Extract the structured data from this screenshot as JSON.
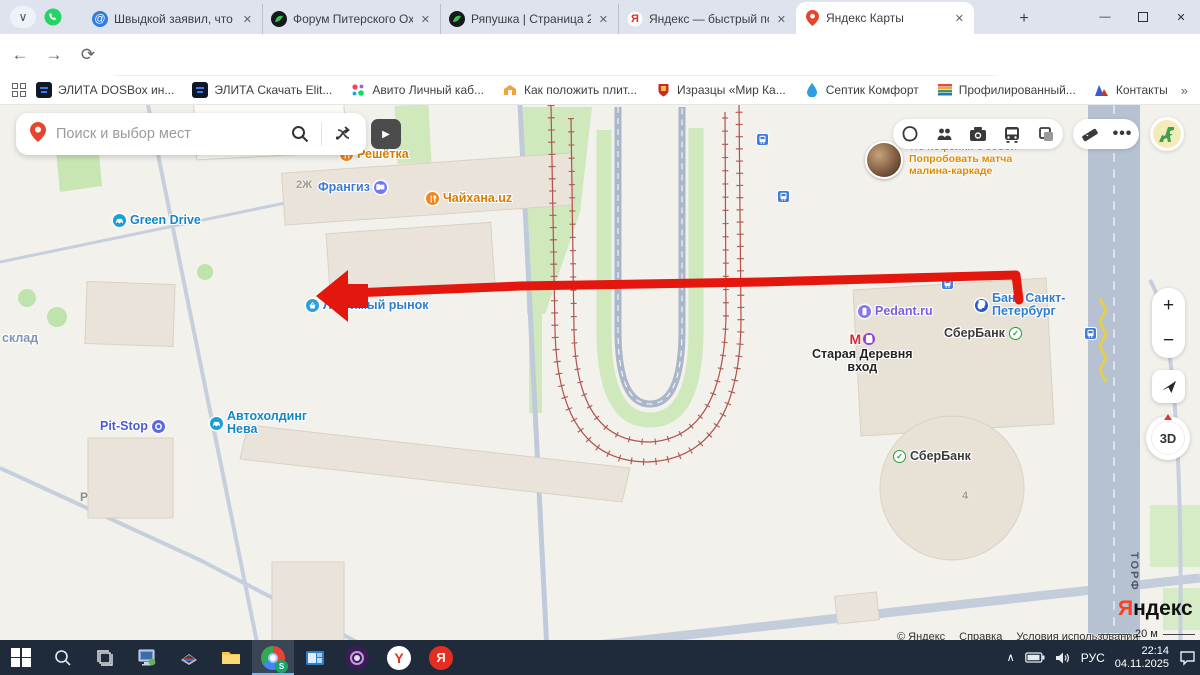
{
  "browser": {
    "tabs": [
      {
        "title": "Швыдкой заявил, что рус",
        "icon": "at-icon",
        "active": false
      },
      {
        "title": "Форум Питерского Охотн",
        "icon": "forum-icon",
        "active": false
      },
      {
        "title": "Ряпушка | Страница 21 | Ф",
        "icon": "forum-icon",
        "active": false
      },
      {
        "title": "Яндекс — быстрый поиск",
        "icon": "yandex-icon",
        "active": false
      },
      {
        "title": "Яндекс Карты",
        "icon": "map-pin-icon",
        "active": true
      }
    ],
    "new_tab_label": "+",
    "url": "yandex.ru/maps/2/saint-petersburg/?ll=30.254433%2C59.989467&utm_campaign=desktop&utm_medium=search&utm_source=maps&z=18.4",
    "profile_initial": "S",
    "bookmarks": [
      {
        "label": "ЭЛИТА DOSBox ин...",
        "icon": "elita-icon"
      },
      {
        "label": "ЭЛИТА Скачать Elit...",
        "icon": "elita-icon"
      },
      {
        "label": "Авито Личный каб...",
        "icon": "avito-icon"
      },
      {
        "label": "Как положить плит...",
        "icon": "tile-icon"
      },
      {
        "label": "Изразцы «Мир Ка...",
        "icon": "shield-icon"
      },
      {
        "label": "Септик Комфорт",
        "icon": "drop-icon"
      },
      {
        "label": "Профилированный...",
        "icon": "stripes-icon"
      },
      {
        "label": "Контакты",
        "icon": "triangle-icon"
      }
    ],
    "bookmarks_more": "»"
  },
  "map": {
    "search_placeholder": "Поиск и выбор мест",
    "promo": {
      "line1": "★5 Кофейня с собой",
      "line2": "Попробовать матча",
      "line3": "малина-каркаде"
    },
    "controls": {
      "zoom_in": "+",
      "zoom_out": "−",
      "compass": "3D"
    },
    "pois": [
      {
        "lines": [
          "Решётка"
        ],
        "x": 340,
        "y": 148,
        "color": "#d87c00",
        "icon": "restaurant-icon",
        "iconBg": "#f0861d",
        "side": "left"
      },
      {
        "lines": [
          "Франгиз"
        ],
        "x": 318,
        "y": 181,
        "color": "#3b7bd8",
        "icon": "scissors-icon",
        "iconBg": "#6f79f7",
        "side": "right"
      },
      {
        "lines": [
          "Чайхана.uz"
        ],
        "x": 426,
        "y": 192,
        "color": "#d87c00",
        "icon": "restaurant-icon",
        "iconBg": "#f0861d",
        "side": "left"
      },
      {
        "lines": [
          "Green Drive"
        ],
        "x": 113,
        "y": 214,
        "color": "#1287c8",
        "icon": "car-icon",
        "iconBg": "#18a0d8",
        "side": "left"
      },
      {
        "lines": [
          "Любимый рынок"
        ],
        "x": 306,
        "y": 299,
        "color": "#2f7dd3",
        "icon": "basket-icon",
        "iconBg": "#28a0dc",
        "side": "left"
      },
      {
        "lines": [
          "склад"
        ],
        "x": 2,
        "y": 332,
        "color": "#7e95b5",
        "icon": null,
        "side": "left"
      },
      {
        "lines": [
          "Pit-Stop"
        ],
        "x": 100,
        "y": 420,
        "color": "#4a5bd0",
        "icon": "tire-icon",
        "iconBg": "#5a6ae0",
        "side": "right"
      },
      {
        "lines": [
          "Автохолдинг",
          "Нева"
        ],
        "x": 210,
        "y": 410,
        "color": "#1287c8",
        "icon": "car-icon",
        "iconBg": "#18a0d8",
        "side": "left"
      },
      {
        "lines": [
          "Pedant.ru"
        ],
        "x": 858,
        "y": 305,
        "color": "#7a5ce0",
        "icon": "phone-icon",
        "iconBg": "#8878f0",
        "side": "left"
      },
      {
        "lines": [
          "Банк Санкт-",
          "Петербург"
        ],
        "x": 975,
        "y": 292,
        "color": "#2f7dd3",
        "icon": "ruble-icon",
        "iconBg": "#2458c8",
        "side": "left"
      },
      {
        "lines": [
          "СберБанк"
        ],
        "x": 944,
        "y": 327,
        "color": "#3c3c3c",
        "icon": "sber-icon",
        "iconBg": "",
        "side": "right"
      },
      {
        "lines": [
          "СберБанк"
        ],
        "x": 893,
        "y": 450,
        "color": "#3c3c3c",
        "icon": "sber-icon",
        "iconBg": "",
        "side": "left"
      },
      {
        "lines": [
          "Старая Деревня",
          "вход"
        ],
        "x": 812,
        "y": 331,
        "color": "#242424",
        "icon": "metro-icon",
        "iconBg": "",
        "side": "top"
      }
    ],
    "transit_stops": [
      {
        "x": 756,
        "y": 133
      },
      {
        "x": 777,
        "y": 190
      },
      {
        "x": 941,
        "y": 277
      },
      {
        "x": 1084,
        "y": 327
      }
    ],
    "map_texts": [
      {
        "t": "2Ж",
        "x": 296,
        "y": 179,
        "c": "#a09a90",
        "s": 11,
        "v": false
      },
      {
        "t": "4",
        "x": 962,
        "y": 490,
        "c": "#a09a90",
        "s": 11,
        "v": false
      },
      {
        "t": "Р",
        "x": 80,
        "y": 490,
        "c": "#8f8f8f",
        "s": 12,
        "v": false
      },
      {
        "t": "ТОРФ",
        "x": 1128,
        "y": 552,
        "c": "#4e5a68",
        "s": 11,
        "v": true
      }
    ],
    "attribution": {
      "copyright": "© Яндекс",
      "help": "Справка",
      "terms": "Условия использования"
    },
    "logo_first_letter": "Я",
    "logo_rest": "ндекс",
    "scale_label": "20 м"
  },
  "taskbar": {
    "lang": "РУС",
    "time": "22:14",
    "date": "04.11.2025"
  },
  "colors": {
    "annotation_red": "#e3170d",
    "fence": "#b0524a",
    "road": "#c6cfdd",
    "building": "#e9e3d9",
    "green": "#cfe9bc"
  }
}
